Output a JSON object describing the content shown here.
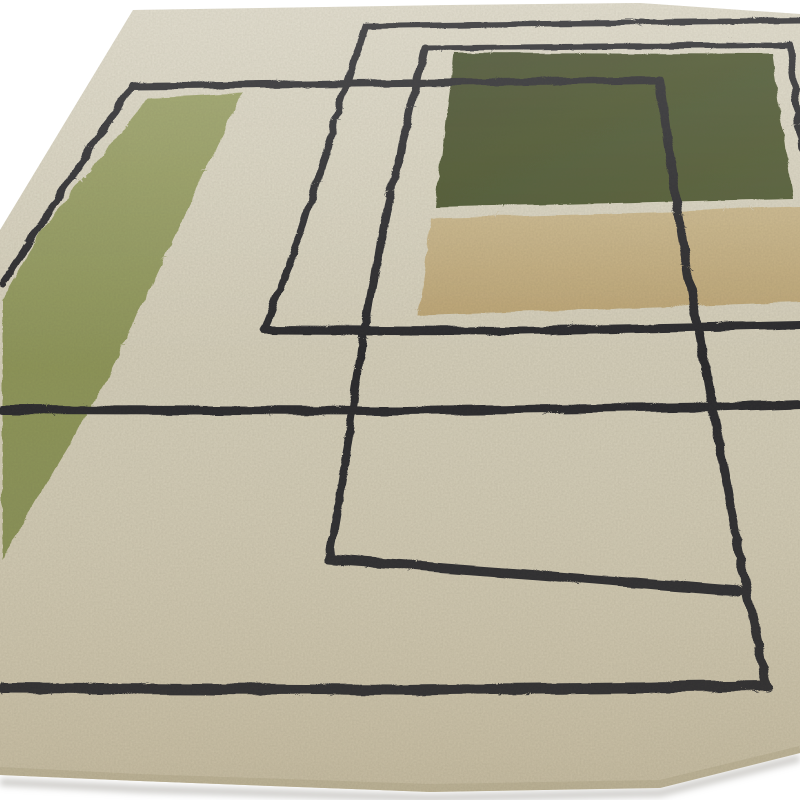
{
  "scene": {
    "title": "Cream geometric wool rug — angled product photograph",
    "description": "Close-up angled photograph of a hand-tufted cream wool rug with a mid-century geometric pattern: thin black overlapping rectangular outlines, an olive green vertical band on the left, a dark forest green rectangle at the top right and a camel tan rectangle beneath it, shot on a plain white studio floor.",
    "background": {
      "label": "white studio floor",
      "color_name": "white"
    },
    "rug": {
      "label": "hand-tufted wool rug",
      "base_color_name": "cream",
      "pattern": "overlapping thin black rectangle outlines with olive, forest green and tan color blocks",
      "blocks": [
        {
          "name": "olive-green-band",
          "color_name": "olive green"
        },
        {
          "name": "forest-green-block",
          "color_name": "forest green"
        },
        {
          "name": "tan-block",
          "color_name": "camel tan"
        }
      ]
    },
    "colors": {
      "white_bg": "#ffffff",
      "cream_light": "#e1dcca",
      "cream": "#d7d1bc",
      "cream_dark": "#cfc5aa",
      "olive_light": "#9aa164",
      "olive": "#879052",
      "green_light": "#515b31",
      "green": "#424c28",
      "tan_light": "#cdb98c",
      "tan": "#c0a877",
      "line_black": "#26262b",
      "edge_band": "#c0b69a",
      "floor_shadow": "#b7b5b0",
      "grain": "#5e5948"
    }
  }
}
